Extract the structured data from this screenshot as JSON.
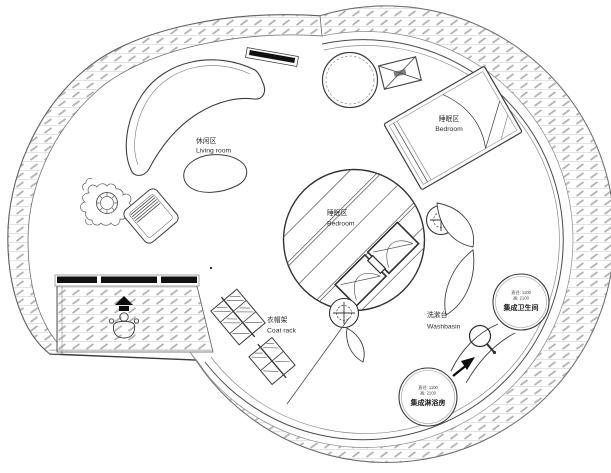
{
  "figure": {
    "kind": "circular tiny-house floor plan, line drawing"
  },
  "labels": {
    "living_room": {
      "zh": "休闲区",
      "en": "Living room"
    },
    "bedroom_loft": {
      "zh": "睡眠区",
      "en": "Bedroom"
    },
    "bedroom_main": {
      "zh": "睡眠区",
      "en": "Bedroom"
    },
    "coat_rack": {
      "zh": "衣帽架",
      "en": "Coat rack"
    },
    "washbasin": {
      "zh": "洗漱台",
      "en": "Washbasin"
    },
    "toilet_pod": {
      "dim_line1": "直径: 1100",
      "dim_line2": "高: 2100",
      "name": "集成卫生间"
    },
    "shower_pod": {
      "dim_line1": "直径: 1100",
      "dim_line2": "高: 2100",
      "name": "集成淋浴房"
    }
  },
  "colors": {
    "line": "#3a3a3a",
    "hatch_tick": "#b4b4b4",
    "hatch_line": "#dcdcdc",
    "background": "#ffffff",
    "solid_fill": "#111111"
  }
}
